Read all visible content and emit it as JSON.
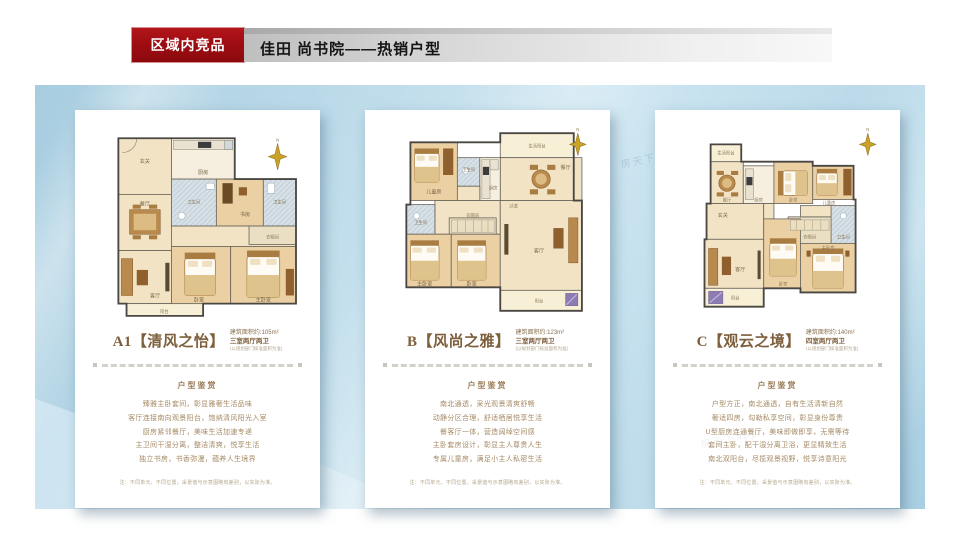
{
  "header": {
    "tag": "区域内竞品",
    "title": "佳田 尚书院——热销户型"
  },
  "watermark": "房天下app",
  "colors": {
    "accent_red": "#9e0d12",
    "panel_blue": "#bcdae9",
    "text_brown": "#9c7f5a"
  },
  "cards": [
    {
      "name": "A1【清风之怡】",
      "area": "建筑面积约:105m²",
      "layout": "三室两厅两卫",
      "approval_note": "(以规划部门核准面积为准)",
      "section_title": "户型鉴赏",
      "features": [
        "臻雅主卧套间，彰显雅奢生活品味",
        "客厅连接南向观景阳台，饱纳清风阳光入室",
        "厨房紧邻餐厅，美味生活加速专递",
        "主卫间干湿分离，整洁清爽，悦享生活",
        "独立书房，书香弥漫，蕴养人生境界"
      ],
      "footnote": "注：不同单元、不同位置，采景值与示意图略有差别，以实际为准。",
      "compass": "N",
      "rooms": {
        "entry": "玄关",
        "kitchen": "厨房",
        "dining": "餐厅",
        "living": "客厅",
        "balcony": "阳台",
        "bath1": "卫生间",
        "study": "书房",
        "bath2": "卫生间",
        "closet": "衣帽间",
        "bed": "卧室",
        "master": "主卧室"
      }
    },
    {
      "name": "B【风尚之雅】",
      "area": "建筑面积约:123m²",
      "layout": "三室两厅两卫",
      "approval_note": "(以规划部门核准面积为准)",
      "section_title": "户型鉴赏",
      "features": [
        "南北通透，采光观景清爽舒畅",
        "动静分区合理，舒适栖居悦享生活",
        "餐客厅一体，营造阔绰空间感",
        "主卧套房设计，彰显主人尊贵人生",
        "专属儿童房，满足小主人私密生活"
      ],
      "footnote": "注：不同单元、不同位置，采景值与示意图略有差别，以实际为准。",
      "compass": "N",
      "rooms": {
        "svc_balcony": "生活阳台",
        "dining": "餐厅",
        "child": "儿童房",
        "bath1": "卫生间",
        "kitchen": "厨房",
        "bath2": "卫生间",
        "closet": "衣帽间",
        "hall": "过道",
        "master": "主卧室",
        "bed": "卧室",
        "living": "客厅",
        "balcony": "阳台"
      }
    },
    {
      "name": "C【观云之境】",
      "area": "建筑面积约:140m²",
      "layout": "四室两厅两卫",
      "approval_note": "(以规划部门核准面积为准)",
      "section_title": "户型鉴赏",
      "features": [
        "户型方正，南北通透，自有生活清新自然",
        "奢适四房，勾勒私享空间，彰显身份尊贵",
        "U型厨房连通餐厅，美味即做即享，无需等待",
        "套间主卧，配干湿分离卫浴，更显精致生活",
        "南北双阳台，尽揽观景视野，悦享诗意阳光"
      ],
      "footnote": "注：不同单元、不同位置，采景值与示意图略有差别，以实际为准。",
      "compass": "N",
      "rooms": {
        "svc_balcony": "生活阳台",
        "dining": "餐厅",
        "kitchen": "厨房",
        "bed_top": "卧室",
        "child": "儿童房",
        "bath": "卫生间",
        "closet": "衣帽间",
        "hall": "玄关",
        "living": "客厅",
        "balcony": "阳台",
        "bed": "卧室",
        "master": "主卧室"
      }
    }
  ]
}
